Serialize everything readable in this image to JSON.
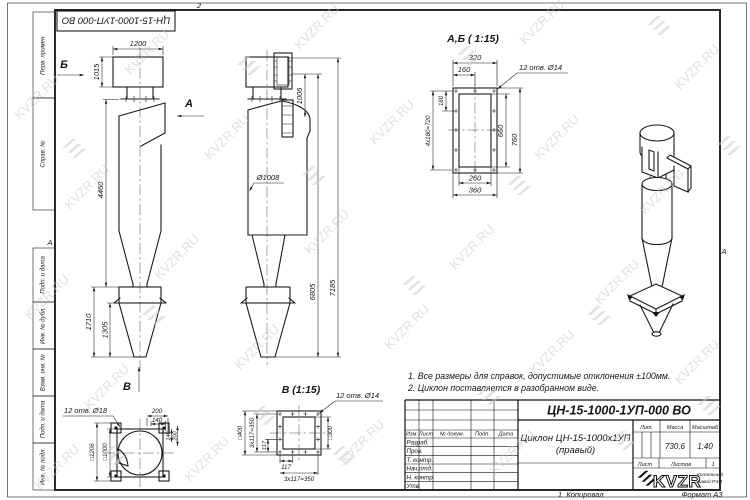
{
  "watermark": {
    "text": "KVZR.RU"
  },
  "frame": {
    "zone_top": "2",
    "zone_bottom": "1",
    "zone_left": "А",
    "zone_right": "А",
    "copied": "Копировал",
    "format": "Формат А3",
    "side_labels": [
      "Перв. примен.",
      "Справ. №",
      "Подп. и дата",
      "Инв. № дубл.",
      "Взам. инв. №",
      "Подп. и дата",
      "Инв. № подл."
    ]
  },
  "front_view": {
    "arrow_b": "Б",
    "arrow_a": "А",
    "arrow_v": "В",
    "dim_width": "1200",
    "dim_height": "1015",
    "dim_body": "4460",
    "dim_cone": "1710",
    "dim_bunker": "1305"
  },
  "side_view": {
    "dim_outlet": "1006",
    "dim_diameter": "Ø1008",
    "dim_h1": "6805",
    "dim_h2": "7185"
  },
  "detail_ab": {
    "title": "А,Б ( 1:15)",
    "holes": "12 отв. Ø14",
    "dim_320": "320",
    "dim_160": "160",
    "dim_180": "180",
    "dim_pitch": "4х180=720",
    "dim_660": "660",
    "dim_760": "760",
    "dim_260": "260",
    "dim_360": "360"
  },
  "detail_top": {
    "holes": "12 отв. Ø18",
    "dim_outer": "□1206",
    "dim_inner": "□1000",
    "dim_200": "200",
    "dim_140": "140",
    "dim_r140": "140",
    "dim_r200": "200"
  },
  "detail_v": {
    "title": "В (1:15)",
    "holes": "12 отв. Ø14",
    "dim_outer": "□400",
    "dim_pitch_l": "3х117=350",
    "dim_117_l": "117",
    "dim_inner": "□300",
    "dim_117_b": "117",
    "dim_pitch_b": "3х117=350"
  },
  "notes": {
    "line1": "1. Все размеры для справок, допустимые отклонения ±100мм.",
    "line2": "2. Циклон поставляется в разобранном виде."
  },
  "title_block": {
    "doc_number": "ЦН-15-1000-1УП-000 ВО",
    "name_line1": "Циклон ЦН-15-1000х1УП",
    "name_line2": "(правый)",
    "col_izm": "Изм.",
    "col_list": "Лист",
    "col_doc": "№ докум.",
    "col_sign": "Подп.",
    "col_date": "Дата",
    "row_razrab": "Разраб.",
    "row_prov": "Пров.",
    "row_tkontr": "Т. контр.",
    "row_nachotd": "Нач.отд.",
    "row_nkontr": "Н. контр.",
    "row_utv": "Утв.",
    "lit": "Лит.",
    "mass": "Масса",
    "scale": "Масштаб",
    "mass_value": "730,6",
    "scale_value": "1:40",
    "sheet": "Лист",
    "sheets": "Листов",
    "sheets_value": "1",
    "logo": "KVZR",
    "logo_sub1": "Котельный",
    "logo_sub2": "завод РЭП"
  }
}
